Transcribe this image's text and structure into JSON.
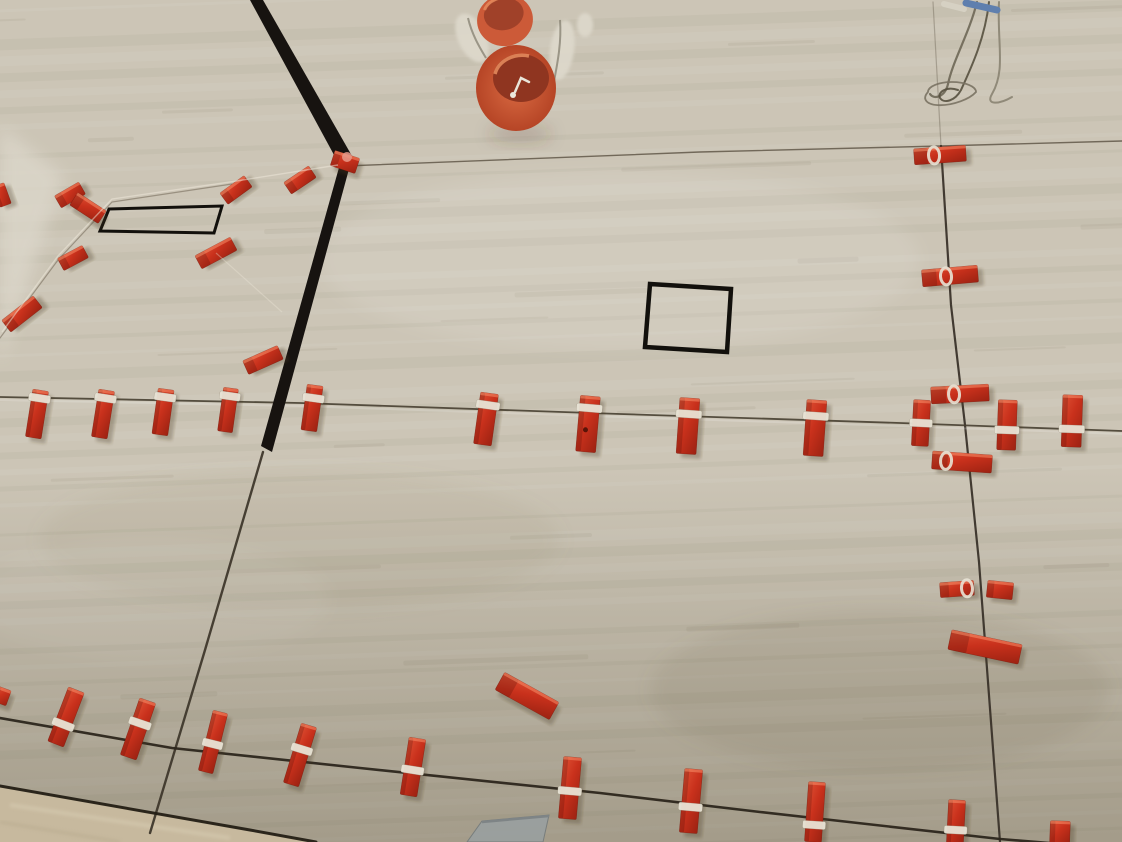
{
  "scene": {
    "alt": "Photo looking up at a ceiling and wall corner covered with large beige travertine-look tiles during installation; red tile-leveling clips and wedges sit along the tile joints, two orange round electrical junction boxes protrude at top center with plaster and wires, loose wires hang at top right, a black square cutout and a black rectangular cutout are visible, and a sliver of floor shows at bottom left."
  },
  "palette": {
    "tile_base": "#ccc5b6",
    "tile_light": "#dad4c7",
    "tile_dark": "#a9a28d",
    "grout": "#473f31",
    "grout_dark": "#2c261c",
    "corner_black": "#171310",
    "cut_outline": "#12100c",
    "clip_red_light": "#df5134",
    "clip_red": "#c9311c",
    "clip_red_dark": "#9c2212",
    "string_white": "#e8e3d5",
    "box_orange": "#cc5a38",
    "box_orange_deep": "#8f3520",
    "plaster_white": "#ddd8cb",
    "wire_gray": "#6e6757",
    "wire_blue": "#5f7fae",
    "floor": "#c7b99e",
    "tool_gray": "#9aa09f"
  },
  "objects": {
    "grout_lines": [
      {
        "name": "joint-top-horizontal",
        "points": [
          [
            345,
            166
          ],
          [
            700,
            152
          ],
          [
            940,
            146
          ],
          [
            1122,
            141
          ]
        ],
        "w": 1.4,
        "color": "#5a5042",
        "op": 0.8
      },
      {
        "name": "joint-right-vertical-upper",
        "points": [
          [
            933,
            2
          ],
          [
            941,
            146
          ]
        ],
        "w": 1.2,
        "color": "#5a5042",
        "op": 0.35
      },
      {
        "name": "joint-right-vertical",
        "points": [
          [
            941,
            146
          ],
          [
            951,
            305
          ],
          [
            965,
            425
          ],
          [
            979,
            562
          ],
          [
            1000,
            842
          ]
        ],
        "w": 2.2,
        "color": "#3a332a",
        "op": 0.95
      },
      {
        "name": "joint-mid-horizontal",
        "points": [
          [
            0,
            397
          ],
          [
            300,
            403
          ],
          [
            620,
            414
          ],
          [
            900,
            423
          ],
          [
            1122,
            431
          ]
        ],
        "w": 1.8,
        "color": "#473f31",
        "op": 0.9
      },
      {
        "name": "joint-corner-lower",
        "points": [
          [
            263,
            452
          ],
          [
            205,
            650
          ],
          [
            150,
            833
          ]
        ],
        "w": 2.4,
        "color": "#3f382c",
        "op": 0.95
      },
      {
        "name": "joint-bottom-horizontal",
        "points": [
          [
            0,
            718
          ],
          [
            172,
            748
          ],
          [
            360,
            768
          ],
          [
            600,
            793
          ],
          [
            760,
            812
          ],
          [
            1000,
            839
          ],
          [
            1122,
            849
          ]
        ],
        "w": 2.6,
        "color": "#2c261c",
        "op": 0.95
      },
      {
        "name": "wall-floor-edge",
        "points": [
          [
            0,
            786
          ],
          [
            250,
            830
          ],
          [
            316,
            842
          ]
        ],
        "w": 3,
        "color": "#241f15",
        "op": 0.95
      },
      {
        "name": "joint-left-faint",
        "points": [
          [
            0,
            338
          ],
          [
            58,
            260
          ],
          [
            112,
            202
          ],
          [
            232,
            184
          ]
        ],
        "w": 1.2,
        "color": "#6f6554",
        "op": 0.55
      }
    ],
    "corner_band": [
      {
        "name": "corner-band-upper",
        "pts": [
          [
            250,
            0
          ],
          [
            263,
            0
          ],
          [
            352,
            156
          ],
          [
            340,
            166
          ]
        ]
      },
      {
        "name": "corner-band-lower",
        "pts": [
          [
            340,
            164
          ],
          [
            352,
            158
          ],
          [
            272,
            452
          ],
          [
            261,
            446
          ]
        ]
      }
    ],
    "cutouts": [
      {
        "name": "rect-cutout-outline",
        "pts": [
          [
            109,
            209
          ],
          [
            222,
            206
          ],
          [
            214,
            233
          ],
          [
            100,
            231
          ]
        ],
        "w": 3
      },
      {
        "name": "square-cutout-outline",
        "pts": [
          [
            650,
            284
          ],
          [
            731,
            289
          ],
          [
            727,
            352
          ],
          [
            645,
            347
          ]
        ],
        "w": 4.5
      }
    ],
    "clips_vertical": [
      {
        "cx": 37,
        "cy": 414,
        "w": 16,
        "h": 48,
        "rot": 9,
        "band": -16
      },
      {
        "cx": 103,
        "cy": 414,
        "w": 16,
        "h": 48,
        "rot": 9,
        "band": -16
      },
      {
        "cx": 163,
        "cy": 412,
        "w": 16,
        "h": 46,
        "rot": 8,
        "band": -15
      },
      {
        "cx": 228,
        "cy": 410,
        "w": 15,
        "h": 44,
        "rot": 8,
        "band": -14
      },
      {
        "cx": 312,
        "cy": 408,
        "w": 16,
        "h": 46,
        "rot": 8,
        "band": -10
      },
      {
        "cx": 486,
        "cy": 419,
        "w": 18,
        "h": 52,
        "rot": 8,
        "band": -14
      },
      {
        "cx": 588,
        "cy": 424,
        "w": 20,
        "h": 56,
        "rot": 5,
        "band": -16,
        "dot": true
      },
      {
        "cx": 688,
        "cy": 426,
        "w": 20,
        "h": 56,
        "rot": 4,
        "band": -12
      },
      {
        "cx": 815,
        "cy": 428,
        "w": 20,
        "h": 56,
        "rot": 4,
        "band": -12
      },
      {
        "cx": 921,
        "cy": 423,
        "w": 17,
        "h": 46,
        "rot": 3,
        "band": 0
      },
      {
        "cx": 1007,
        "cy": 425,
        "w": 19,
        "h": 50,
        "rot": 2,
        "band": 5
      },
      {
        "cx": 1072,
        "cy": 421,
        "w": 20,
        "h": 52,
        "rot": 2,
        "band": 8
      },
      {
        "cx": 66,
        "cy": 717,
        "w": 17,
        "h": 58,
        "rot": 21,
        "band": 8
      },
      {
        "cx": 138,
        "cy": 729,
        "w": 17,
        "h": 60,
        "rot": 19,
        "band": -6
      },
      {
        "cx": 213,
        "cy": 742,
        "w": 15,
        "h": 62,
        "rot": 14,
        "band": 2
      },
      {
        "cx": 300,
        "cy": 755,
        "w": 16,
        "h": 62,
        "rot": 17,
        "band": -6
      },
      {
        "cx": 413,
        "cy": 767,
        "w": 17,
        "h": 58,
        "rot": 9,
        "band": 3
      },
      {
        "cx": 570,
        "cy": 788,
        "w": 18,
        "h": 62,
        "rot": 5,
        "band": 3
      },
      {
        "cx": 691,
        "cy": 801,
        "w": 18,
        "h": 64,
        "rot": 5,
        "band": 6
      },
      {
        "cx": 815,
        "cy": 812,
        "w": 17,
        "h": 60,
        "rot": 4,
        "band": 13
      },
      {
        "cx": 956,
        "cy": 822,
        "w": 17,
        "h": 44,
        "rot": 3,
        "band": 8
      },
      {
        "cx": 1060,
        "cy": 832,
        "w": 20,
        "h": 22,
        "rot": 2,
        "band": null
      }
    ],
    "clips_horizontal": [
      {
        "cx": 940,
        "cy": 155,
        "w": 52,
        "h": 16,
        "rot": -4,
        "loop": -6
      },
      {
        "cx": 950,
        "cy": 276,
        "w": 56,
        "h": 17,
        "rot": -5,
        "loop": -4
      },
      {
        "cx": 960,
        "cy": 394,
        "w": 58,
        "h": 17,
        "rot": -3,
        "loop": -6
      },
      {
        "cx": 962,
        "cy": 462,
        "w": 60,
        "h": 18,
        "rot": 4,
        "loop": -16
      },
      {
        "cx": 957,
        "cy": 589,
        "w": 34,
        "h": 15,
        "rot": -4,
        "loop": 10
      },
      {
        "cx": 1000,
        "cy": 590,
        "w": 26,
        "h": 17,
        "rot": 6,
        "loop": null
      },
      {
        "cx": 985,
        "cy": 647,
        "w": 72,
        "h": 20,
        "rot": 12,
        "loop": null
      },
      {
        "cx": 527,
        "cy": 696,
        "w": 62,
        "h": 20,
        "rot": 29,
        "loop": null
      }
    ],
    "clips_angled": [
      {
        "cx": 22,
        "cy": 314,
        "w": 40,
        "h": 15,
        "rot": -38
      },
      {
        "cx": 2,
        "cy": 195,
        "w": 12,
        "h": 22,
        "rot": -20
      },
      {
        "cx": 70,
        "cy": 195,
        "w": 28,
        "h": 14,
        "rot": -30
      },
      {
        "cx": 88,
        "cy": 208,
        "w": 34,
        "h": 15,
        "rot": 33
      },
      {
        "cx": 73,
        "cy": 258,
        "w": 28,
        "h": 14,
        "rot": -28
      },
      {
        "cx": 236,
        "cy": 190,
        "w": 30,
        "h": 14,
        "rot": -36
      },
      {
        "cx": 216,
        "cy": 253,
        "w": 40,
        "h": 15,
        "rot": -28
      },
      {
        "cx": 300,
        "cy": 180,
        "w": 30,
        "h": 14,
        "rot": -34
      },
      {
        "cx": 263,
        "cy": 360,
        "w": 38,
        "h": 15,
        "rot": -24
      },
      {
        "cx": 345,
        "cy": 162,
        "w": 26,
        "h": 16,
        "rot": 18
      },
      {
        "cx": 2,
        "cy": 696,
        "w": 14,
        "h": 16,
        "rot": 20
      }
    ],
    "strings": [
      {
        "name": "leveling-string-left",
        "points": [
          [
            2,
            332
          ],
          [
            58,
            256
          ],
          [
            112,
            199
          ],
          [
            230,
            182
          ],
          [
            338,
            165
          ]
        ],
        "w": 1.4,
        "op": 0.5
      },
      {
        "name": "leveling-string-left-lower",
        "points": [
          [
            216,
            253
          ],
          [
            282,
            312
          ]
        ],
        "w": 1.2,
        "op": 0.35
      }
    ],
    "wires": {
      "strands": [
        {
          "d": "M977,2 C969,34 953,60 948,84 C945,97 934,100 930,94",
          "color": "#6e6757",
          "w": 2.2
        },
        {
          "d": "M989,2 C985,38 972,66 961,90 C955,101 944,104 940,98 C937,92 947,86 958,90",
          "color": "#57503f",
          "w": 2
        },
        {
          "d": "M999,2 C997,44 1006,70 992,94 C985,106 1000,104 1012,97",
          "color": "#8a8372",
          "w": 2
        },
        {
          "d": "M928,92 a24,10 -15 1 0 48,0 a24,10 0 1 0 -48,0",
          "color": "#7a7263",
          "w": 1.8
        }
      ],
      "blue_tip": {
        "x1": 966,
        "y1": 3,
        "x2": 997,
        "y2": 10
      },
      "white_tip": {
        "x1": 944,
        "y1": 4,
        "x2": 964,
        "y2": 9
      }
    },
    "junction_boxes": {
      "small": {
        "cx": 505,
        "cy": 20,
        "rx": 28,
        "ry": 26,
        "open_rx": 20,
        "open_ry": 16,
        "rot": -12
      },
      "large": {
        "cx": 516,
        "cy": 88,
        "rx": 40,
        "ry": 43,
        "open_cx": 521,
        "open_cy": 78,
        "open_rx": 28,
        "open_ry": 24
      }
    },
    "plaster_blobs": [
      {
        "cx": 472,
        "cy": 38,
        "rx": 14,
        "ry": 26,
        "rot": -25
      },
      {
        "cx": 562,
        "cy": 50,
        "rx": 12,
        "ry": 30,
        "rot": 8
      },
      {
        "cx": 585,
        "cy": 25,
        "rx": 8,
        "ry": 12,
        "rot": 0
      }
    ],
    "floor": {
      "pts": [
        [
          0,
          787
        ],
        [
          250,
          831
        ],
        [
          316,
          842
        ],
        [
          0,
          842
        ]
      ]
    },
    "tool": {
      "pts": [
        [
          482,
          821
        ],
        [
          549,
          815
        ],
        [
          543,
          842
        ],
        [
          467,
          842
        ]
      ]
    }
  }
}
